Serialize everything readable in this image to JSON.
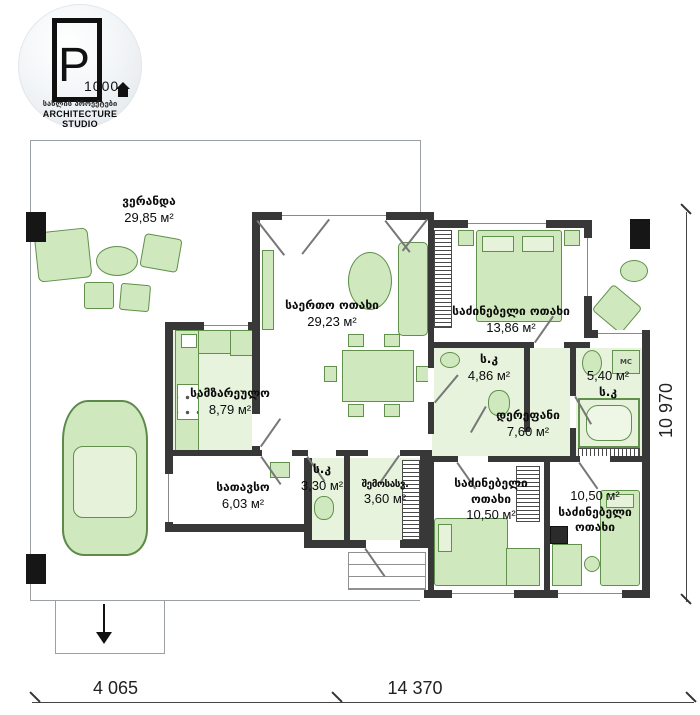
{
  "logo": {
    "letter": "P",
    "number": "1000",
    "tagline_ka": "სახლის პროექტები",
    "tagline_en": "ARCHITECTURE STUDIO"
  },
  "rooms": [
    {
      "id": "veranda",
      "name": "ვერანდა",
      "area": "29,85 м²"
    },
    {
      "id": "living",
      "name": "საერთო ოთახი",
      "area": "29,23 м²"
    },
    {
      "id": "kitchen",
      "name": "სამზარეულო",
      "area": "8,79 м²"
    },
    {
      "id": "storage",
      "name": "სათავსო",
      "area": "6,03 м²"
    },
    {
      "id": "wc-small",
      "name": "ს.კ",
      "area": "3,30 м²"
    },
    {
      "id": "entry",
      "name": "შემოსასვ.",
      "area": "3,60 м²"
    },
    {
      "id": "bedroom-1",
      "name": "საძინებელი ოთახი",
      "area": "13,86 м²"
    },
    {
      "id": "bath-1",
      "name": "ს.კ",
      "area": "4,86 м²"
    },
    {
      "id": "corridor",
      "name": "დერეფანი",
      "area": "7,60 м²"
    },
    {
      "id": "bath-2",
      "name": "ს.კ",
      "area": "5,40 м²"
    },
    {
      "id": "bedroom-2",
      "name_l1": "საძინებელი",
      "name_l2": "ოთახი",
      "area": "10,50 м²"
    },
    {
      "id": "bedroom-3",
      "name_l1": "საძინებელი",
      "name_l2": "ოთახი",
      "area": "10,50 м²"
    }
  ],
  "labels": {
    "washing_machine": "МС"
  },
  "dimensions": {
    "bottom_left": "4 065",
    "bottom_right": "14 370",
    "right": "10 970"
  },
  "colors": {
    "wall": "#383838",
    "furniture_fill": "#cfe8bd",
    "furniture_stroke": "#60904c",
    "floor_tint": "#e7f3dd"
  }
}
